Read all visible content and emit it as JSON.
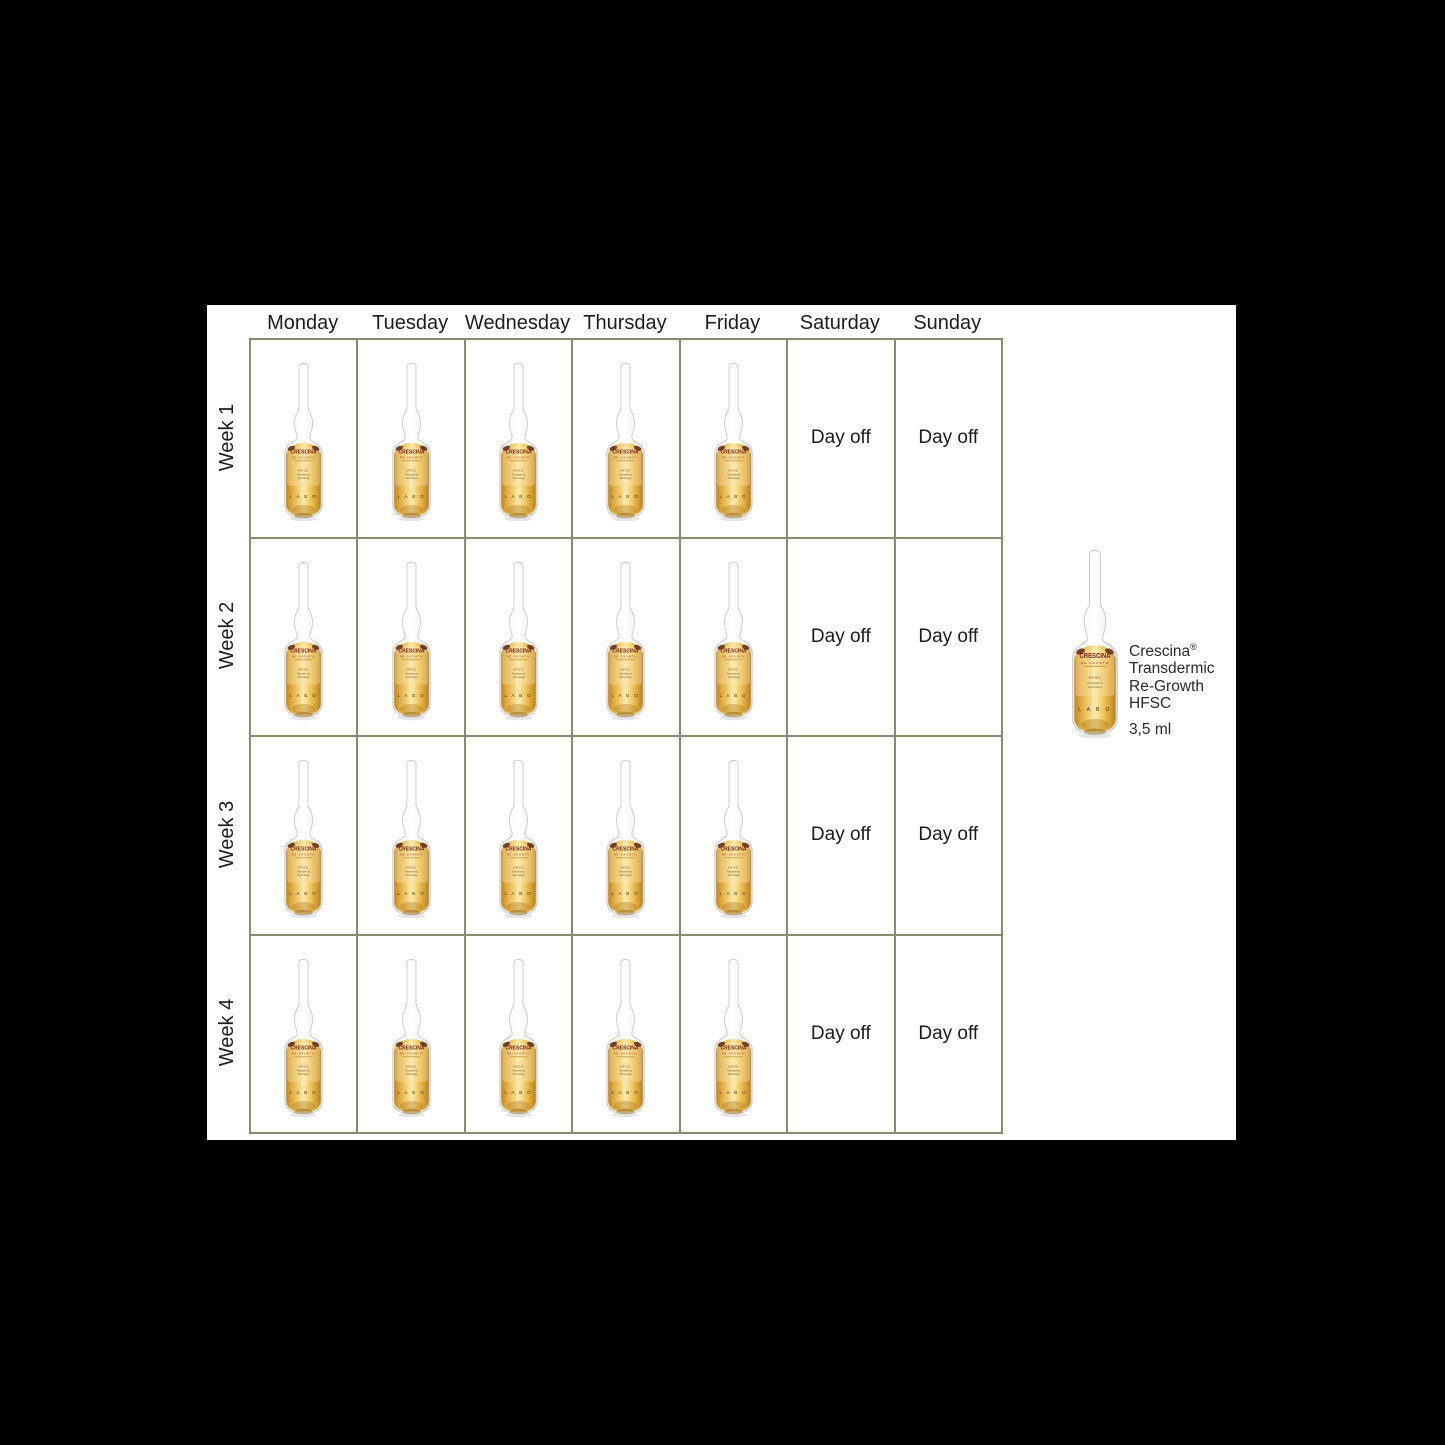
{
  "stage": {
    "background": "#000000"
  },
  "content": {
    "background": "#ffffff"
  },
  "colors": {
    "table_border": "#8b8b71",
    "text": "#1c1c1c",
    "liquid_center": "#f4d77e",
    "liquid_edge": "#bf8520",
    "label_red": "#a3342a"
  },
  "schedule": {
    "day_headers": [
      "Monday",
      "Tuesday",
      "Wednesday",
      "Thursday",
      "Friday",
      "Saturday",
      "Sunday"
    ],
    "week_labels": [
      "Week 1",
      "Week 2",
      "Week 3",
      "Week 4"
    ],
    "treatment_days_per_week": 5,
    "weekend_label": "Day off"
  },
  "ampoule_label": {
    "brand": "CRESCINA",
    "range": "RE-GROWTH",
    "code": "HFSC",
    "tech_line1": "Transdermic",
    "tech_line2": "Technology",
    "maker_marks": "L A B O"
  },
  "legend": {
    "name": "Crescina",
    "registered_mark": "®",
    "line2": "Transdermic",
    "line3": "Re-Growth",
    "line4": "HFSC",
    "volume": "3,5 ml"
  }
}
